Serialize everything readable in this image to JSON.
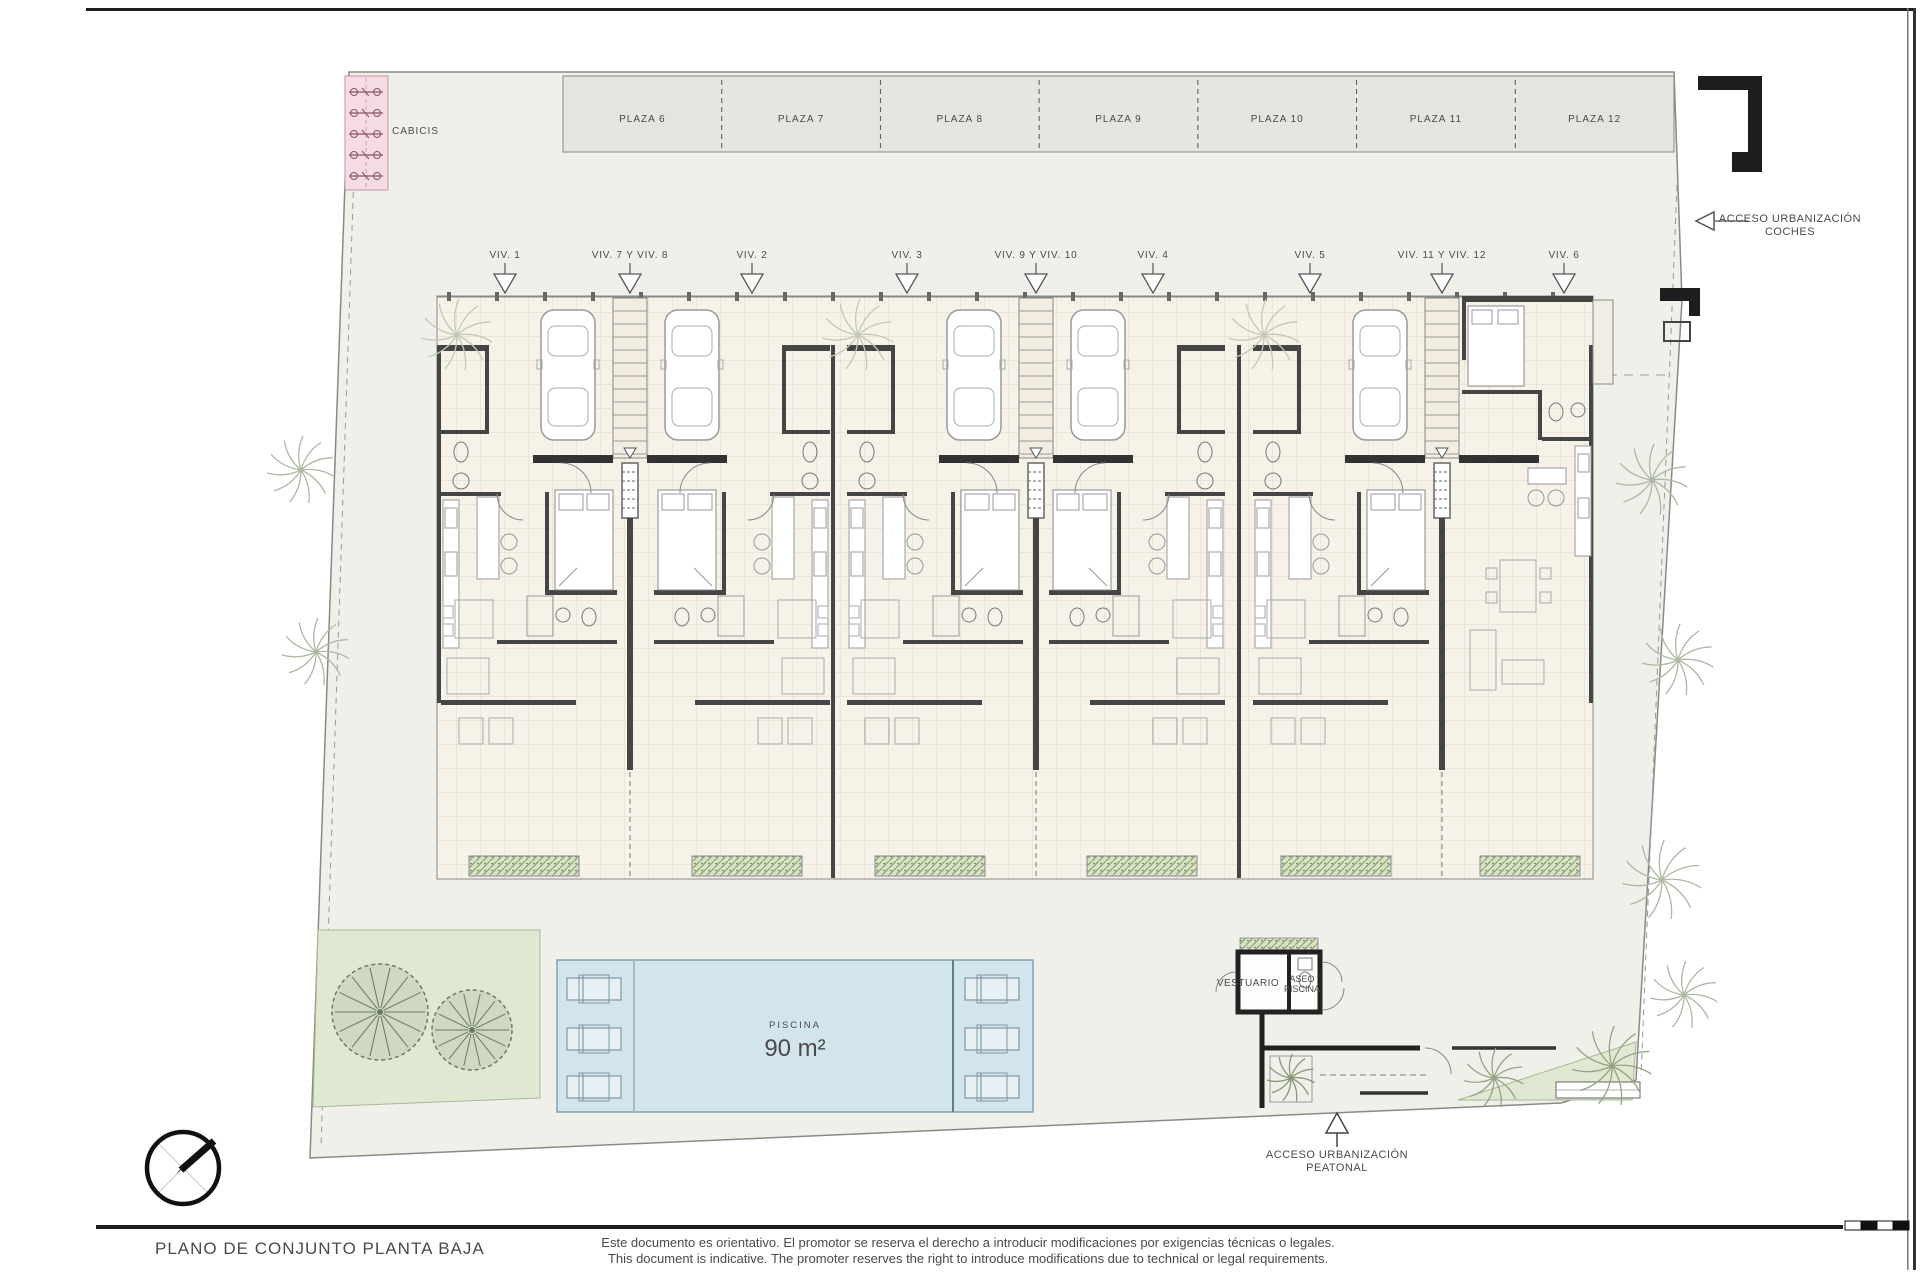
{
  "title_block": {
    "title": "PLANO DE CONJUNTO PLANTA BAJA",
    "disclaimer_es": "Este documento es orientativo. El promotor se reserva el derecho a introducir modificaciones por exigencias técnicas o legales.",
    "disclaimer_en": "This document is indicative. The promoter reserves the right to introduce modifications due to technical or legal requirements."
  },
  "site": {
    "bike_storage_label": "CABICIS",
    "parking_plazas": [
      "PLAZA 6",
      "PLAZA 7",
      "PLAZA 8",
      "PLAZA 9",
      "PLAZA 10",
      "PLAZA 11",
      "PLAZA 12"
    ],
    "units": [
      "VIV. 1",
      "VIV. 7 Y VIV. 8",
      "VIV. 2",
      "VIV. 3",
      "VIV. 9 Y VIV. 10",
      "VIV. 4",
      "VIV. 5",
      "VIV. 11 Y VIV. 12",
      "VIV. 6"
    ],
    "access": {
      "cars_line1": "ACCESO URBANIZACIÓN",
      "cars_line2": "COCHES",
      "pedestrian_line1": "ACCESO URBANIZACIÓN",
      "pedestrian_line2": "PEATONAL"
    },
    "pool": {
      "label": "PISCINA",
      "area": "90 m²"
    },
    "changing_room_label": "VESTUARIO",
    "pool_wc_line1": "ASEO",
    "pool_wc_line2": "PISCINA"
  },
  "colors": {
    "site_fill": "#f0f0ea",
    "site_stroke": "#8a8a84",
    "parking_fill": "#e4e4e1",
    "tile_fill": "#f7f2e8",
    "tile_line": "#e2d8c6",
    "wall": "#454545",
    "pool_fill": "#d3e5ec",
    "pool_stroke": "#7fa3b2",
    "green_fill": "#dfe8d0",
    "green_stroke": "#a9b897",
    "pink_fill": "#f6dbe4",
    "pink_stroke": "#c295a4",
    "ink": "#1d1d1d",
    "label": "#555555"
  }
}
